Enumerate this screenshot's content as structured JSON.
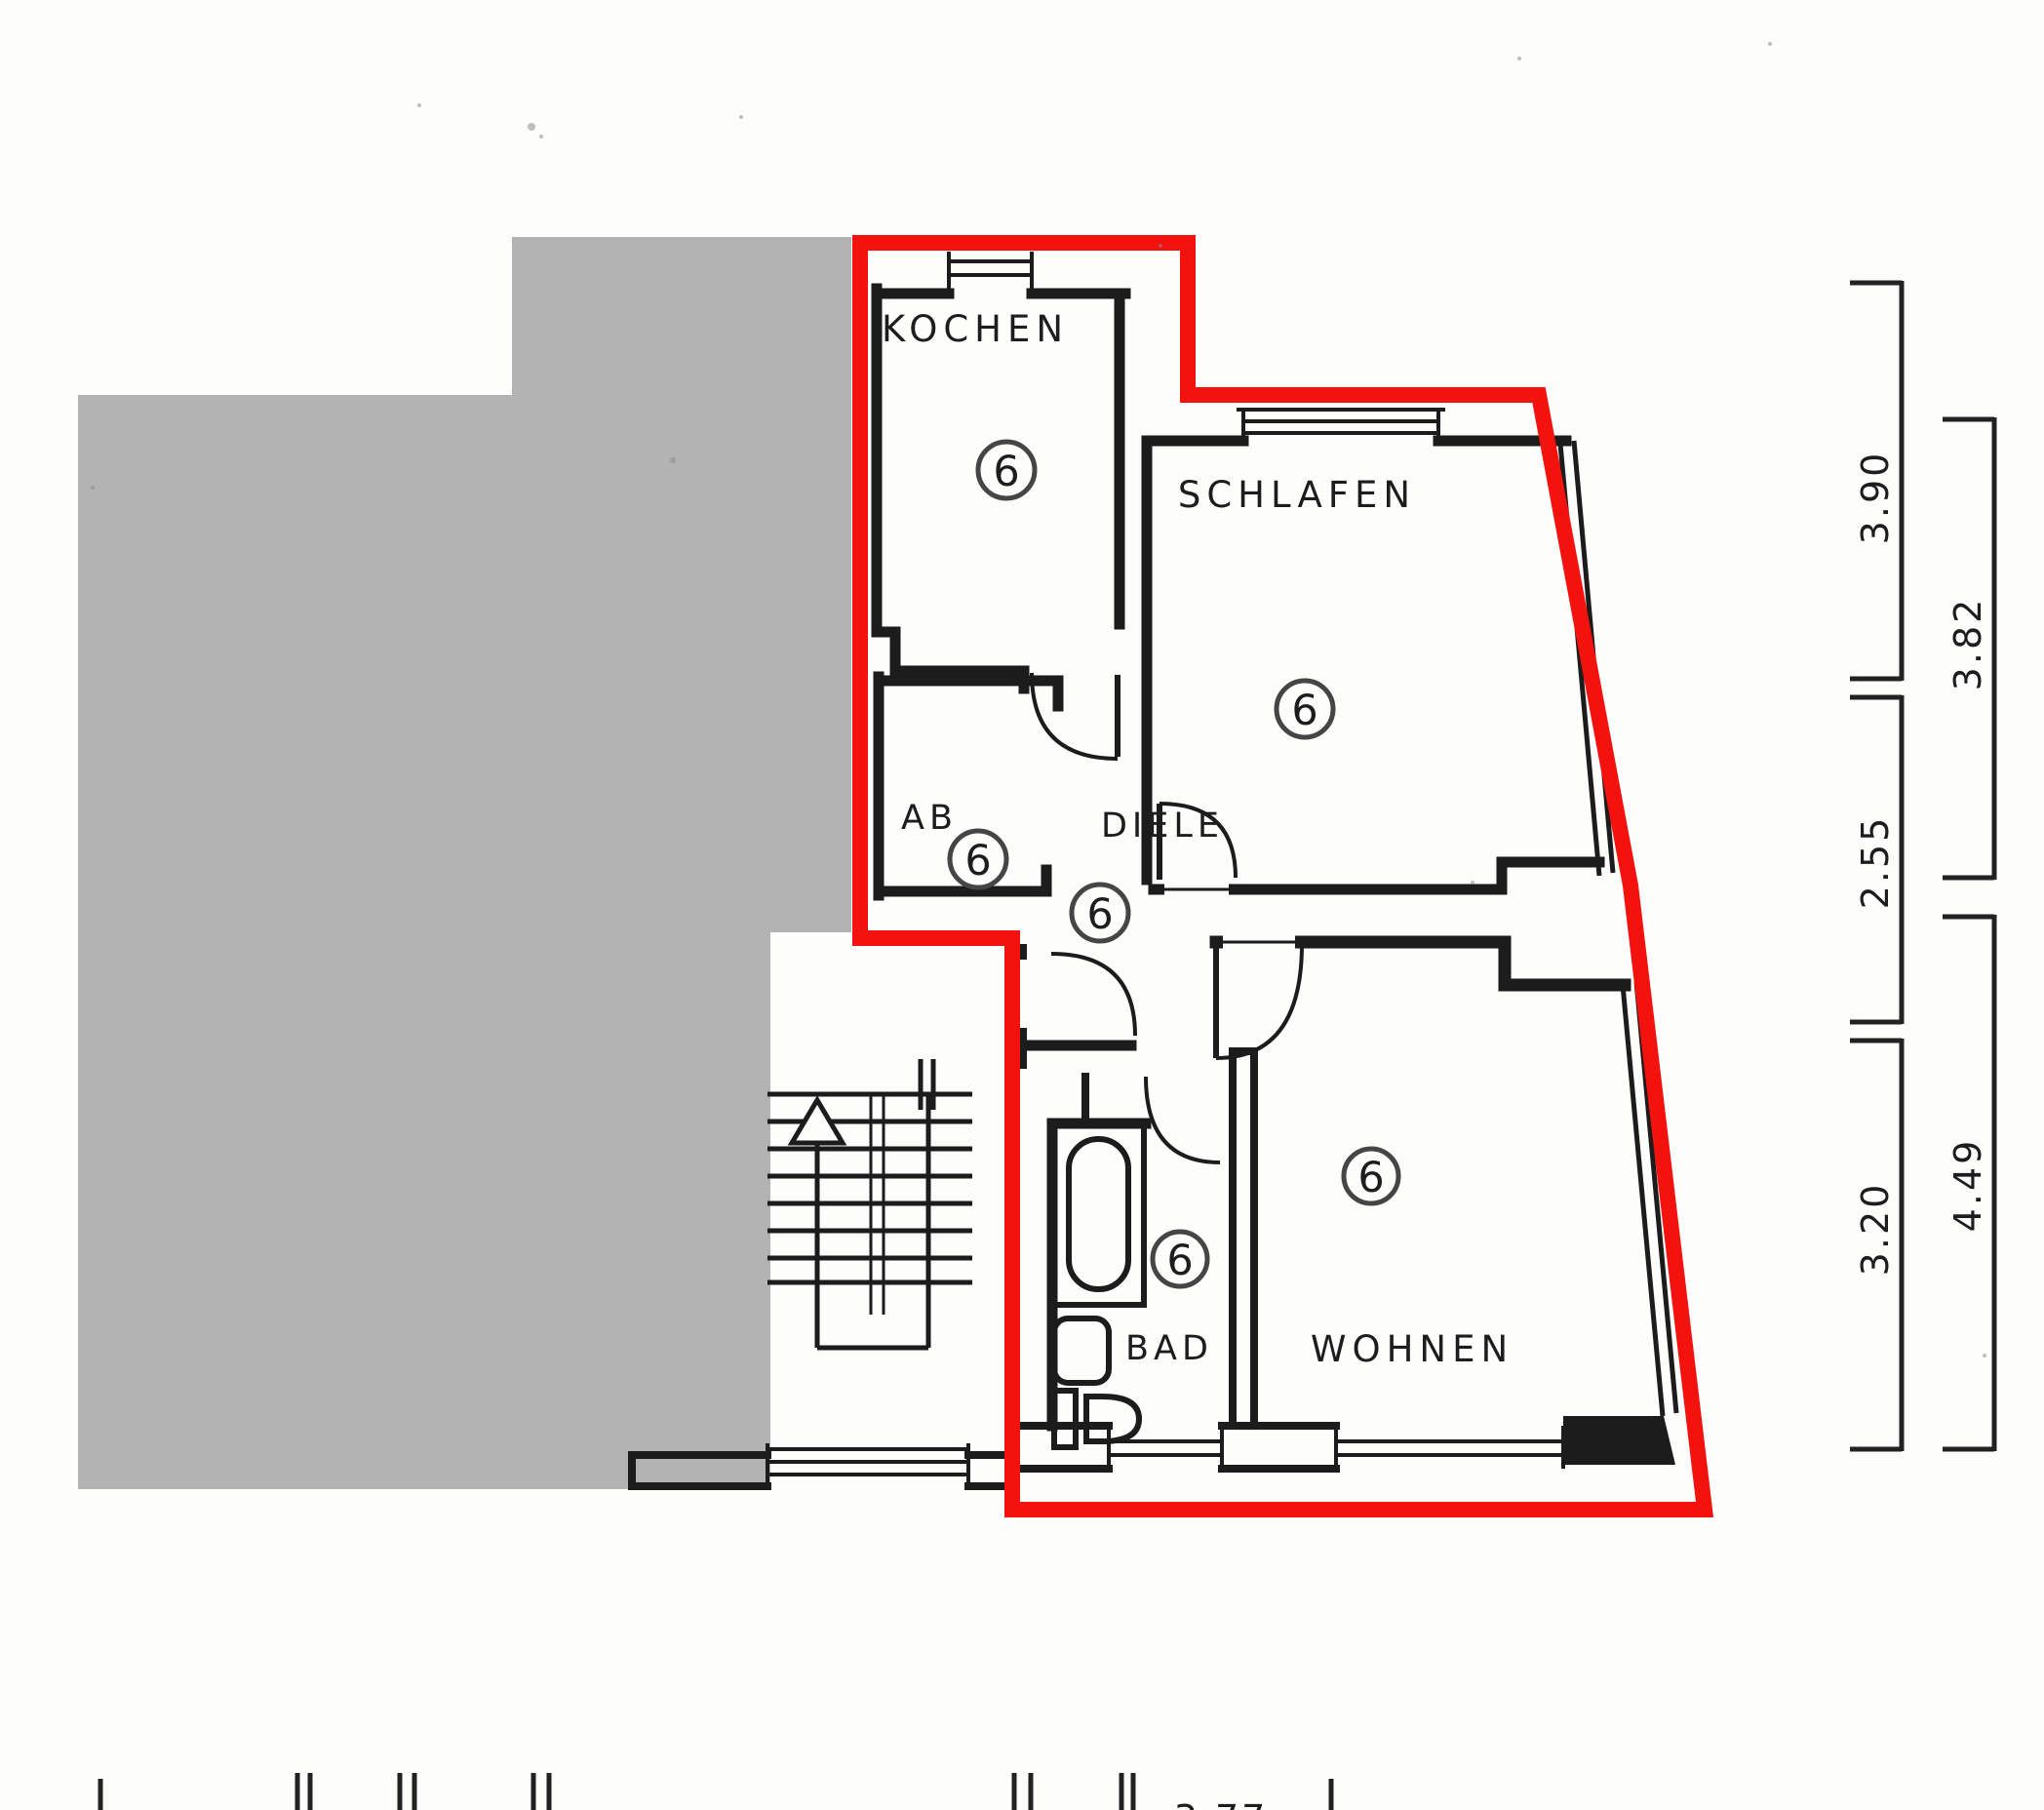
{
  "plan": {
    "title": "apartment-floor-plan-unit-6",
    "unit_number": "6",
    "rooms": [
      {
        "id": "kochen",
        "label": "KOCHEN"
      },
      {
        "id": "schlafen",
        "label": "SCHLAFEN"
      },
      {
        "id": "ab",
        "label": "AB"
      },
      {
        "id": "diele",
        "label": "DIELE"
      },
      {
        "id": "bad",
        "label": "BAD"
      },
      {
        "id": "wohnen",
        "label": "WOHNEN"
      }
    ],
    "dimensions": {
      "right_inner": [
        "3.90",
        "2.55",
        "3.20"
      ],
      "right_outer": [
        "3.82",
        "4.49"
      ],
      "bottom_partial": "3.77"
    },
    "colors": {
      "highlight": "#f3120e",
      "neighbor": "#b3b3b3",
      "wall": "#1c1c1c",
      "paper": "#fdfdfc"
    }
  }
}
